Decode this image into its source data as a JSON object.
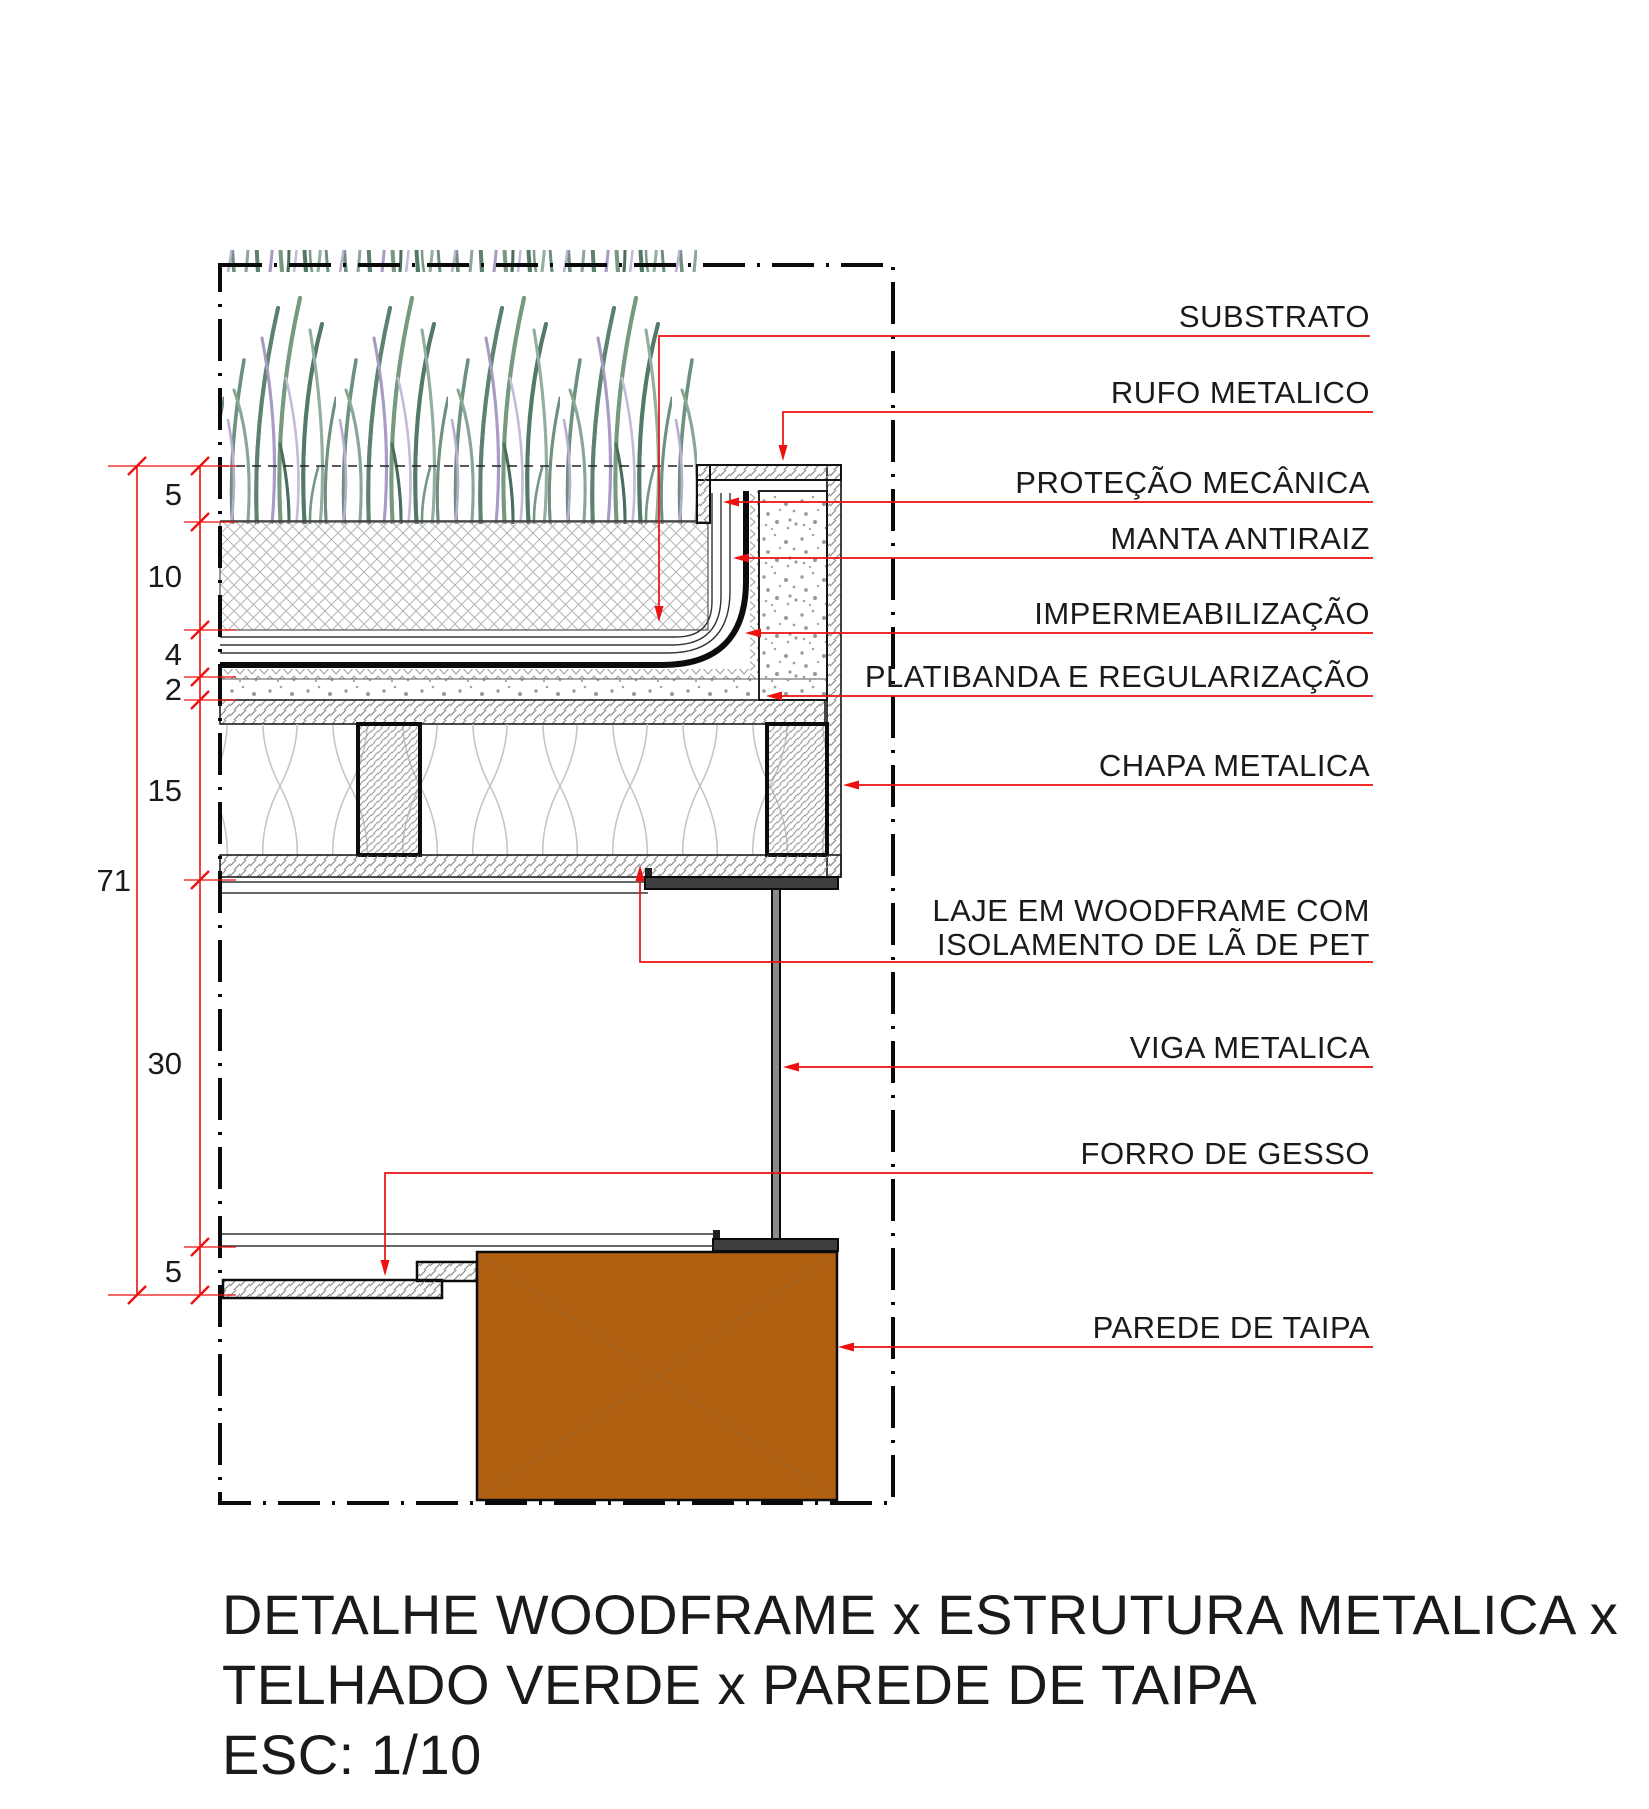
{
  "drawing": {
    "annotations": [
      {
        "id": "substrato",
        "text": "SUBSTRATO"
      },
      {
        "id": "rufo-metalico",
        "text": "RUFO METALICO"
      },
      {
        "id": "protecao-mecanica",
        "text": "PROTEÇÃO MECÂNICA"
      },
      {
        "id": "manta-antiraiz",
        "text": "MANTA ANTIRAIZ"
      },
      {
        "id": "impermeabilizacao",
        "text": "IMPERMEABILIZAÇÃO"
      },
      {
        "id": "platibanda",
        "text": "PLATIBANDA E REGULARIZAÇÃO"
      },
      {
        "id": "chapa-metalica",
        "text": "CHAPA METALICA"
      },
      {
        "id": "laje-woodframe",
        "line1": "LAJE EM WOODFRAME COM",
        "line2": "ISOLAMENTO DE LÃ DE PET"
      },
      {
        "id": "viga-metalica",
        "text": "VIGA METALICA"
      },
      {
        "id": "forro-gesso",
        "text": "FORRO DE GESSO"
      },
      {
        "id": "parede-taipa",
        "text": "PAREDE DE TAIPA"
      }
    ],
    "dimensions": {
      "substrato": "5",
      "drenagem": "10",
      "mantas": "4",
      "regularizacao": "2",
      "laje": "15",
      "pe_direito": "30",
      "forro": "5",
      "total": "71"
    },
    "title": {
      "line1": "DETALHE WOODFRAME x ESTRUTURA METALICA x",
      "line2": "TELHADO VERDE x PAREDE DE TAIPA",
      "scale": "ESC: 1/10"
    },
    "colors": {
      "leader_red": "#ee0f0f",
      "taipa_brown": "#b15f10",
      "line_black": "#1a1a1a"
    }
  }
}
